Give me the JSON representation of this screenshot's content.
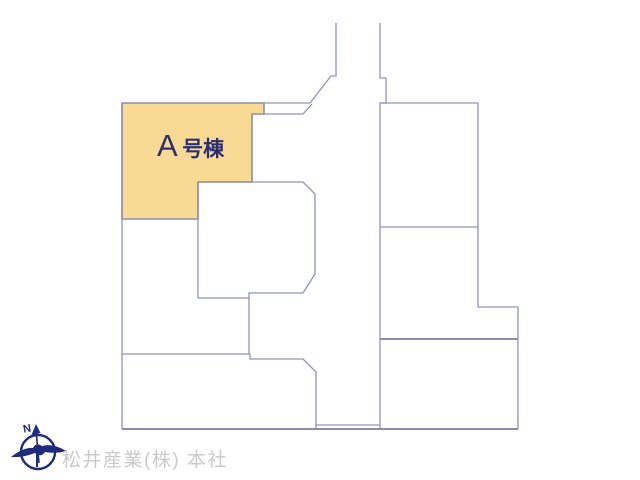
{
  "plan": {
    "highlight_lot": {
      "prefix": "A",
      "suffix": "号棟",
      "full_label": "A号棟"
    },
    "compass": {
      "north_label": "N"
    },
    "watermark": "松井産業(株) 本社"
  },
  "colors": {
    "background": "#FFFFFF",
    "highlight_fill": "#F9DA94",
    "boundary_line": "#9093B6",
    "label_text": "#2B2E73",
    "compass_navy": "#1F2B7D",
    "watermark_gray": "#C9C9C9"
  },
  "shapes": {
    "lot_a": "122,103 264,103 264,114 252,114 252,182 198,182 198,219 122,219",
    "left_edge": "122,103 122,429",
    "road_left": "336,23 336,76 331,76 310,103 264,103",
    "lane_bottom": "264,114 303,114 312,104",
    "road_right": "380,23 380,78 386,78 386,103 380,103 380,429",
    "right_lots_outline": "380,103 478,103 478,307 518,307 518,429",
    "right_divider_1": "380,227 478,227",
    "right_divider_2": "380,339 518,339",
    "central_lot": "198,182 303,182 315,194 315,274 303,293 249,293 249,298 198,298",
    "strip_left": "249,298 249,354",
    "mid_left_divider": "122,354 250,354 250,359 303,359 316,372 316,429",
    "bottom_strip": "316,425 380,425",
    "bottom_line": "122,429 518,429"
  }
}
